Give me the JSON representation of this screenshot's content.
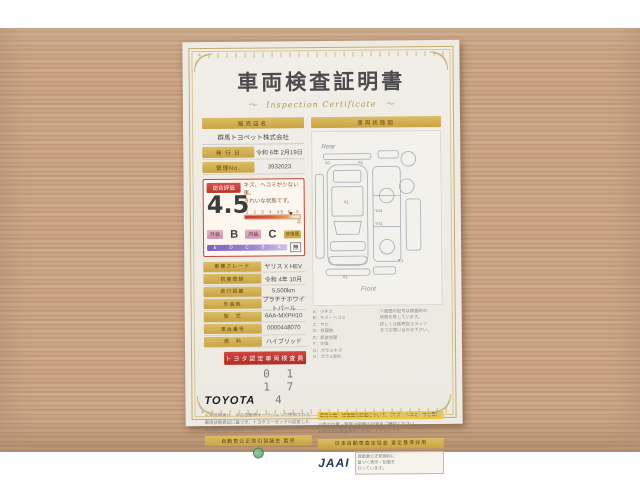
{
  "colors": {
    "wood": "#c9a383",
    "gold": "#cfa94a",
    "rating_red": "#c8463a",
    "scale_purple": "#8f76c9",
    "paper": "#edebe4",
    "jaai_navy": "#2a3560",
    "stamp_green": "#58a06a"
  },
  "certificate": {
    "title": "車両検査証明書",
    "subtitle": "～　Inspection Certificate　～",
    "dealer": {
      "header": "販売店名",
      "name": "群馬トヨペット株式会社"
    },
    "issue": {
      "label": "発 行 日",
      "value": "令和 6年 2月19日"
    },
    "manage": {
      "label": "管理No.",
      "value": "3932023"
    },
    "rating": {
      "label": "総合評価",
      "score": "4.5",
      "comment": "キズ、ヘコミが少ない車。\nきれいな状態です。",
      "ticks": [
        "1",
        "2",
        "3",
        "4",
        "4.5",
        "5",
        "S"
      ],
      "unit": "点",
      "exterior_label": "外装",
      "exterior_grade": "B",
      "interior_label": "内装",
      "interior_grade": "C",
      "repair_label": "修復歴",
      "repair_value": "無",
      "grade_scale": [
        "E",
        "D",
        "C",
        "B",
        "A"
      ]
    },
    "specs": [
      {
        "label": "車種グレード",
        "value": "ヤリス X HEV"
      },
      {
        "label": "初度登録",
        "value": "令和 4年 10月"
      },
      {
        "label": "走行距離",
        "value": "5,500km"
      },
      {
        "label": "外装色",
        "value": "プラチナホワイトパール"
      },
      {
        "label": "型　式",
        "value": "6AA-MXPH10"
      },
      {
        "label": "車台番号",
        "value": "0000448070"
      },
      {
        "label": "燃　料",
        "value": "ハイブリッド"
      }
    ],
    "inspector_banner": "トヨタ認定車両検査員",
    "brand": "TOYOTA",
    "cert_number": "0 1 1 7 4",
    "diagram": {
      "header": "車両状態図",
      "rear": "Rear",
      "front": "Front",
      "markers": [
        "A1",
        "A1",
        "A1",
        "Y41",
        "Y41",
        "A1",
        "E1"
      ]
    },
    "legend": {
      "left": "A：小キズ\nB：キズ・ヘコミ\nC：サビ\nD：修理跡\nE：板金修理\nF：交換\nG：ガラスキズ\nH：ガラス割れ",
      "right": "※図面の記号は検査時の\n状態を表しています。\n詳しくは販売店スタッフ\nまでお問い合わせ下さい。"
    },
    "footer": {
      "note": "※本証明書は、中古自動車オークションで使用される\n車両状態表記に基づき、トヨタユーゼックの認定した\n検査員が厳正に検査・評価したものです。",
      "left_bar": "自動車公正取引協議会 監修",
      "highlight": "車両の傷・修復歴の記載について、（キズ・ヘコミ・サビ等）",
      "right_note": "※傷の位置・程度は図面の記号をご確認ください。\n※評価点は検査時点の状態によるものです。",
      "right_bar": "日本自動車査定協会 査定基準採用",
      "jaai": "JAAI",
      "side_note": "自動車公正競規約に\n基づく表示・記載を\n行っています。"
    }
  }
}
